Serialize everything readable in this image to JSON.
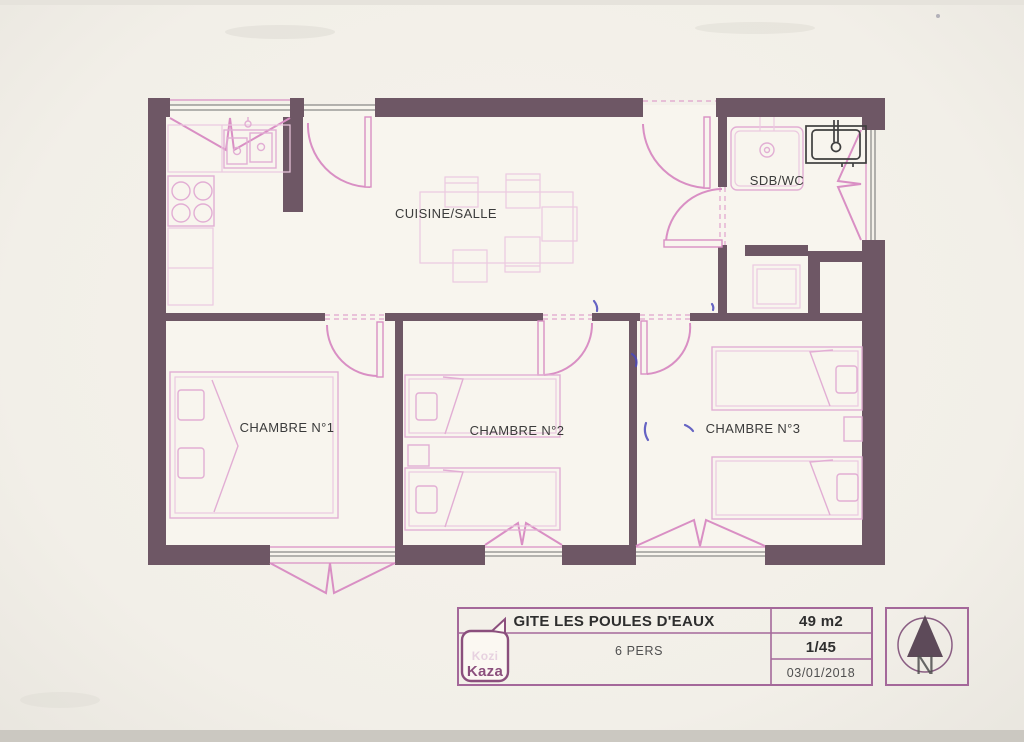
{
  "colors": {
    "wall": "#6e5765",
    "door_pink": "#d98fc4",
    "furniture_pink": "#e2aed4",
    "light_pink": "#ecc9e0",
    "text_dark": "#3b3b3b",
    "table_border": "#a4689a",
    "logo_purple": "#8b4f7d",
    "logo_faint": "#e7d2e0",
    "basin_dark": "#3f3f3f",
    "compass_dark": "#5d4a59",
    "ink_blue": "#4b49bb"
  },
  "plan": {
    "rooms": [
      {
        "id": "cuisine",
        "label": "CUISINE/SALLE"
      },
      {
        "id": "sdb",
        "label": "SDB/WC"
      },
      {
        "id": "chambre1",
        "label": "CHAMBRE N°1"
      },
      {
        "id": "chambre2",
        "label": "CHAMBRE N°2"
      },
      {
        "id": "chambre3",
        "label": "CHAMBRE N°3"
      }
    ]
  },
  "title_block": {
    "name": "GITE LES POULES D'EAUX",
    "area": "49 m2",
    "capacity": "6 PERS",
    "scale": "1/45",
    "date": "03/01/2018"
  },
  "logo": {
    "line1": "Kozi",
    "line2": "Kaza"
  },
  "compass": {
    "label": "N"
  }
}
